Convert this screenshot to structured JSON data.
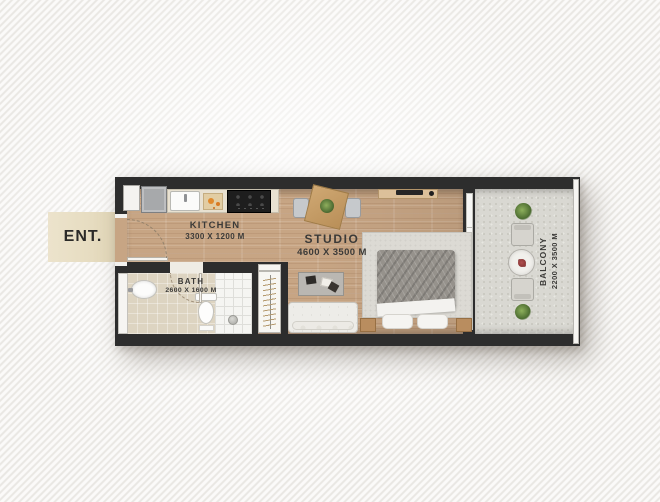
{
  "meta": {
    "type": "apartment-floor-plan",
    "unit": "studio-apartment"
  },
  "entrance": {
    "label": "ENT."
  },
  "rooms": {
    "kitchen": {
      "name": "KITCHEN",
      "dimensions": "3300 X 1200 M"
    },
    "studio": {
      "name": "STUDIO",
      "dimensions": "4600 X 3500 M"
    },
    "bath": {
      "name": "BATH",
      "dimensions": "2600 X 1600 M"
    },
    "balcony": {
      "name": "BALCONY",
      "dimensions": "2200 X 3500 M"
    }
  },
  "furniture": {
    "kitchen": [
      "tall-cabinet",
      "fridge",
      "sink",
      "cutting-board",
      "stove"
    ],
    "bath": [
      "washbasin",
      "toilet",
      "shower",
      "floor-drain",
      "bath-mat"
    ],
    "studio": [
      "dining-table",
      "dining-chair-left",
      "dining-chair-right",
      "tv-console",
      "wardrobe",
      "coffee-table",
      "sofa",
      "rug",
      "double-bed",
      "nightstand-left",
      "nightstand-right"
    ],
    "balcony": [
      "plant-top",
      "armchair-top",
      "round-table",
      "flower-pot",
      "armchair-bottom",
      "plant-bottom"
    ]
  },
  "doors": [
    "entrance-swing-door",
    "bath-swing-door",
    "balcony-glass-door"
  ],
  "colors": {
    "wall": "#2d2d2d",
    "wood_floor": "#c7a584",
    "balcony_floor": "#d9d8d2",
    "bath_floor": "#ddd4c1",
    "entrance_banner": "#e9dfc6",
    "label_text": "#3b3a38",
    "background": "#f1f0ee"
  }
}
